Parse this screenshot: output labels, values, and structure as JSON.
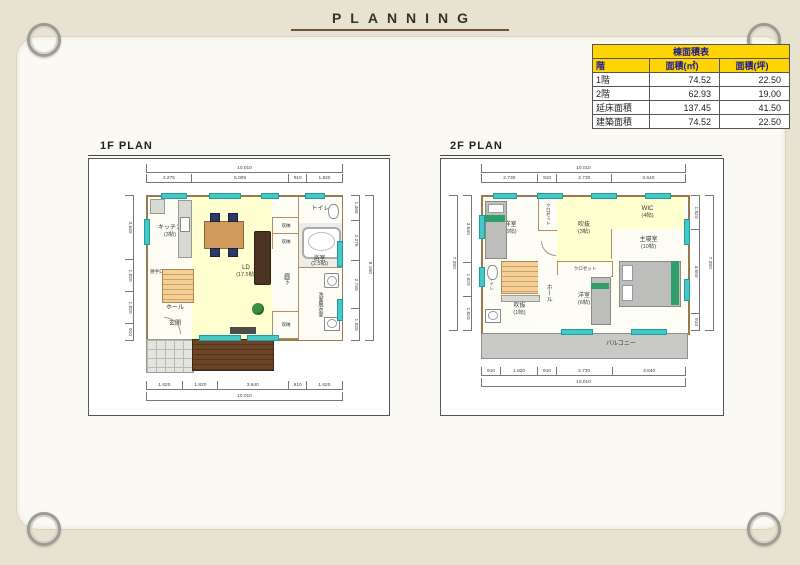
{
  "page": {
    "title": "PLANNING",
    "tagline": "· · · · · · · · · · · · · · · · · · · · · · · · · · · · · · · · · · · · · · · · · · · · · ·"
  },
  "colors": {
    "background_beige": "#e8e3d1",
    "paper_white": "#faf9f3",
    "table_header_bg": "#ffd405",
    "table_header_text": "#1b1b8f",
    "floor_yellow": "#ffffd0",
    "window_teal": "#45c8c8",
    "wall_brown": "#9a7a4a",
    "deck_brown": "#5a3a24",
    "stairs_orange": "#f2c98c",
    "balcony_gray": "#c9c9c7",
    "title_rule_maroon": "#6e553a"
  },
  "area_table": {
    "title": "棟面積表",
    "col_floor": "階",
    "col_sqm": "面積(㎡)",
    "col_tsubo": "面積(坪)",
    "rows": [
      {
        "floor": "1階",
        "sqm": "74.52",
        "tsubo": "22.50"
      },
      {
        "floor": "2階",
        "sqm": "62.93",
        "tsubo": "19.00"
      },
      {
        "floor": "延床面積",
        "sqm": "137.45",
        "tsubo": "41.50"
      },
      {
        "floor": "建築面積",
        "sqm": "74.52",
        "tsubo": "22.50"
      }
    ]
  },
  "plan_1f": {
    "title": "1F PLAN",
    "dim_total_top": "10.010",
    "dims_top": [
      "2.275",
      "5.005",
      "910",
      "1.820"
    ],
    "dims_bottom": [
      "1.820",
      "1.820",
      "3.640",
      "910",
      "1.820"
    ],
    "dim_total_bottom": "10.010",
    "dims_left": [
      "3.640",
      "1.820",
      "1.820",
      "910"
    ],
    "dims_right": [
      "1.365",
      "2.275",
      "2.730",
      "1.820"
    ],
    "dim_total_right": "8.190",
    "rooms": {
      "kitchen": {
        "label": "キッチン",
        "size": "(3帖)"
      },
      "ld": {
        "label": "LD",
        "size": "(17.5帖)"
      },
      "toilet": {
        "label": "トイレ"
      },
      "bath": {
        "label": "浴室",
        "size": "(2.5帖)"
      },
      "washroom": {
        "label": "洗面脱衣室"
      },
      "storage1": {
        "label": "収納"
      },
      "storage2": {
        "label": "収納"
      },
      "storage3": {
        "label": "収納"
      },
      "corridor": {
        "label": "廊下"
      },
      "hall": {
        "label": "ホール"
      },
      "entrance": {
        "label": "玄関"
      },
      "service_door": {
        "label": "勝手口"
      }
    }
  },
  "plan_2f": {
    "title": "2F PLAN",
    "dim_total_top": "10.010",
    "dims_top": [
      "2.730",
      "910",
      "2.730",
      "3.640"
    ],
    "dims_bottom": [
      "910",
      "1.820",
      "910",
      "2.730",
      "3.640"
    ],
    "dim_total_bottom": "10.010",
    "dims_left": [
      "3.640",
      "1.820",
      "1.820"
    ],
    "dim_total_left": "7.280",
    "dims_right": [
      "1.820",
      "4.550",
      "910"
    ],
    "dim_total_right": "7.280",
    "rooms": {
      "bedroom1": {
        "label": "洋室",
        "size": "(6帖)"
      },
      "closet1": {
        "label": "クロゼット"
      },
      "void": {
        "label": "吹抜",
        "size": "(3帖)"
      },
      "wic": {
        "label": "WIC",
        "size": "(4帖)"
      },
      "master": {
        "label": "主寝室",
        "size": "(10帖)"
      },
      "closet2": {
        "label": "クロゼット"
      },
      "bedroom2": {
        "label": "洋室",
        "size": "(6帖)"
      },
      "toilet": {
        "label": "トイレ"
      },
      "hall": {
        "label": "ホール"
      },
      "void2": {
        "label": "吹抜",
        "size": "(1帖)"
      },
      "balcony": {
        "label": "バルコニー"
      }
    }
  }
}
